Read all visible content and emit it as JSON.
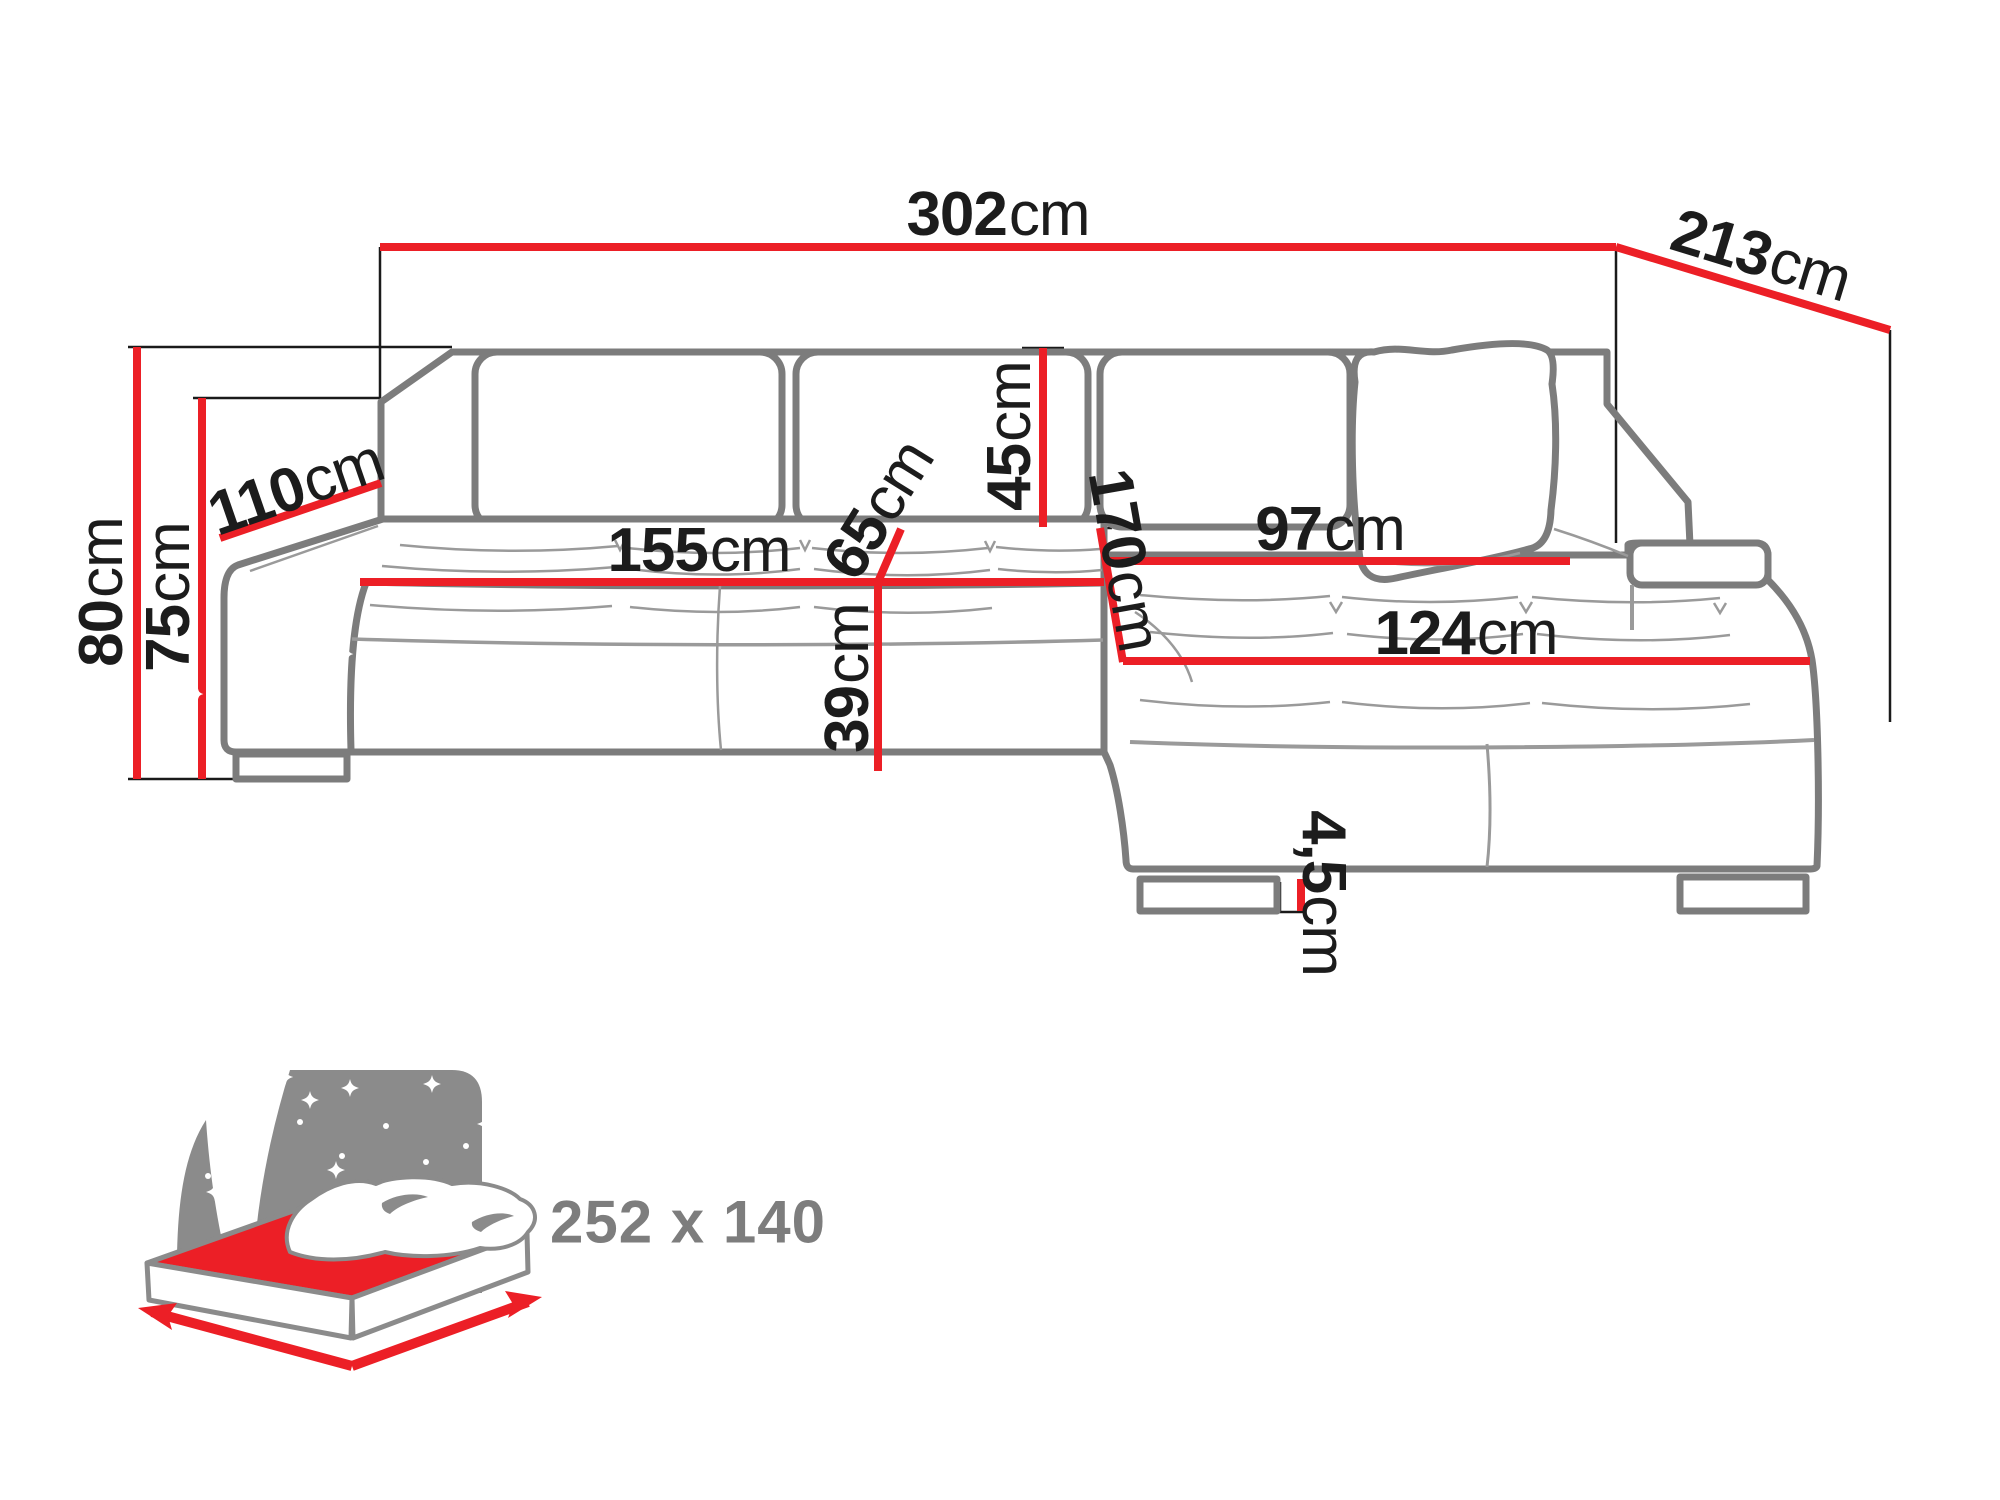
{
  "diagram": {
    "title": "corner-sofa-dimension-diagram",
    "unit": "cm",
    "dimensions": [
      {
        "name": "total-width",
        "value": "302",
        "unit": "cm"
      },
      {
        "name": "total-depth",
        "value": "213",
        "unit": "cm"
      },
      {
        "name": "total-height",
        "value": "80",
        "unit": "cm"
      },
      {
        "name": "backrest-height",
        "value": "75",
        "unit": "cm"
      },
      {
        "name": "armrest-depth",
        "value": "110",
        "unit": "cm"
      },
      {
        "name": "seat-width",
        "value": "155",
        "unit": "cm"
      },
      {
        "name": "seat-depth",
        "value": "65",
        "unit": "cm"
      },
      {
        "name": "backrest-cushion-height",
        "value": "45",
        "unit": "cm"
      },
      {
        "name": "chaise-length",
        "value": "170",
        "unit": "cm"
      },
      {
        "name": "chaise-width-back",
        "value": "97",
        "unit": "cm"
      },
      {
        "name": "chaise-width-front",
        "value": "124",
        "unit": "cm"
      },
      {
        "name": "seat-height",
        "value": "39",
        "unit": "cm"
      },
      {
        "name": "leg-height",
        "value": "4,5",
        "unit": "cm"
      }
    ],
    "sleeping_area": {
      "label": "252 x 140"
    },
    "colors": {
      "dimension_red": "#ec1f26",
      "outline_gray": "#7c7c7c",
      "text_dark": "#1c1c1c",
      "icon_gray": "#8b8b8b"
    }
  }
}
